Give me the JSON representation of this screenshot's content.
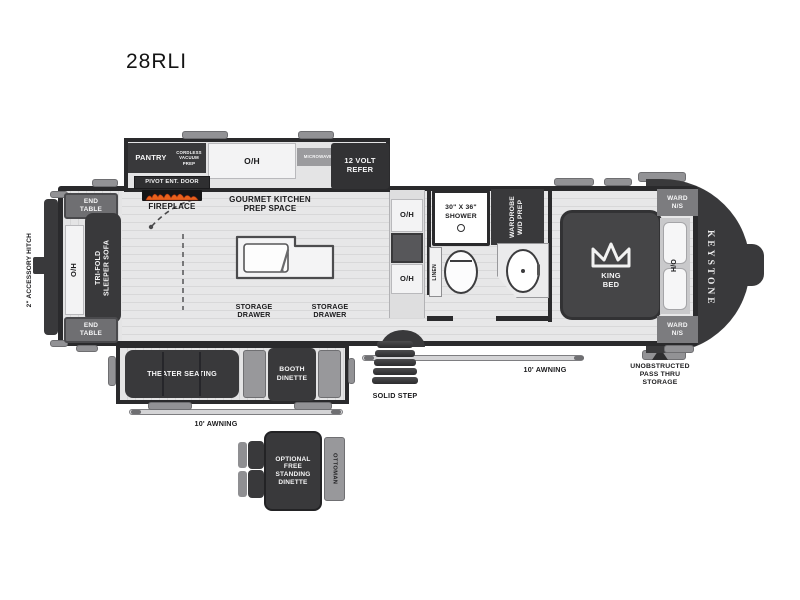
{
  "title": "28RLI",
  "colors": {
    "dark_furniture": "#39393b",
    "outline": "#2a2a2c",
    "mid_gray": "#7c7c7f",
    "light_gray": "#98989b",
    "floor": "#e4e4e5",
    "white_fixture": "#f3f3f4",
    "flame_orange": "#e8611c"
  },
  "exterior": {
    "accessory_hitch": "2\" ACCESSORY HITCH",
    "keystone_logo": "KEYSTONE",
    "awning_left": "10' AWNING",
    "awning_right": "10' AWNING",
    "solid_step": "SOLID STEP",
    "pass_thru": "UNOBSTRUCTED PASS THRU STORAGE"
  },
  "living": {
    "end_table_top": "END TABLE",
    "end_table_bottom": "END TABLE",
    "overhead": "O/H",
    "sofa": "TRI-FOLD SLEEPER SOFA",
    "fireplace": "FIREPLACE",
    "theater": "THEATER SEATING"
  },
  "kitchen": {
    "pantry": "PANTRY",
    "cordless_vacuum": "CORDLESS VACUUM PREP",
    "pivot_door": "PIVOT ENT. DOOR",
    "overhead": "O/H",
    "microwave": "MICROWAVE",
    "refer": "12 VOLT REFER",
    "gourmet": "GOURMET KITCHEN PREP SPACE",
    "storage_drawer_left": "STORAGE DRAWER",
    "storage_drawer_right": "STORAGE DRAWER",
    "oh_upper": "O/H",
    "oh_lower": "O/H",
    "booth": "BOOTH DINETTE",
    "optional_dinette": "OPTIONAL FREE STANDING DINETTE",
    "ottoman": "OTTOMAN"
  },
  "bath": {
    "shower": "30\" X 36\" SHOWER",
    "wardrobe": "WARDROBE W/D PREP",
    "linen": "LINEN"
  },
  "bedroom": {
    "king_bed": "KING BED",
    "ward_top": "WARD N/S",
    "ward_bottom": "WARD N/S",
    "ho": "H/O"
  }
}
